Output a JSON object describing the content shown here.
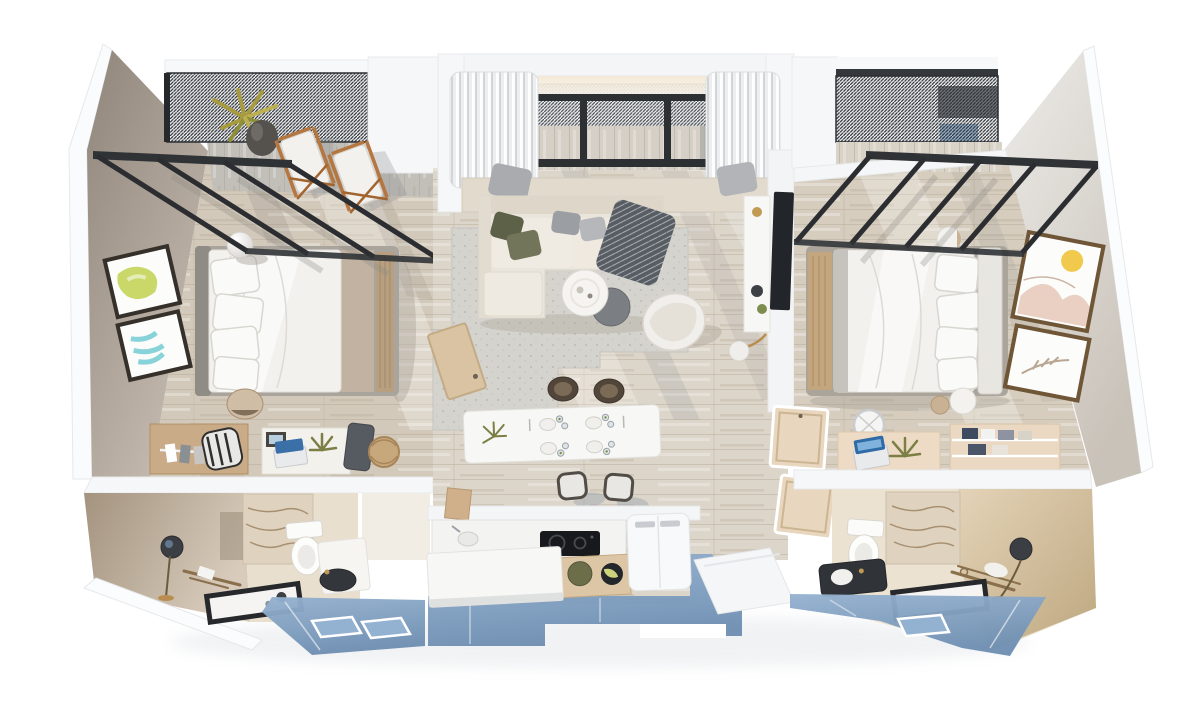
{
  "scene": {
    "title": "3D cutaway floor plan render of a two-bedroom apartment, top-down axonometric view",
    "view": "top-down 3d cutaway",
    "background": "#ffffff"
  },
  "palette": {
    "wall_white": "#f5f6f7",
    "wall_taupe": "#9d9187",
    "wall_light_gray": "#dcd8d2",
    "wood_floor": "#d6cdbf",
    "deck_gray": "#c2bfb9",
    "rug_gray": "#d5d3ce",
    "sofa_beige": "#eae5dc",
    "pillow_olive": "#6e7253",
    "throw_charcoal": "#585d64",
    "glass_blue": "#82a0c0",
    "pergola_black": "#2c2f33",
    "travertine": "#dfd3bf",
    "cabinet_tan": "#dcc6a5",
    "accent_gold": "#c09a55",
    "art_lime": "#c9d869",
    "art_cyan": "#74ccd4",
    "art_yellow": "#f1ca4d",
    "laptop_blue": "#2f6ba6"
  },
  "rooms": {
    "terrace": {
      "label": "Roof terrace with louvered pergola canopies",
      "items": [
        "louvered mesh canopy",
        "black steel glass-canopy frames",
        "two wooden deck chairs with white canvas",
        "potted agave plant",
        "timber deck"
      ]
    },
    "left_bedroom": {
      "label": "Left bedroom",
      "items": [
        "double bed with white duvet and four pillows",
        "gray upholstered headboard",
        "two framed artworks (lime and teal)",
        "white sphere lamp",
        "round side stool",
        "wardrobe with clothes rail",
        "striped desk chair",
        "desk with photo frame and blue laptop",
        "potted plant",
        "dark travel bag",
        "woven basket"
      ]
    },
    "left_bathroom": {
      "label": "Left en-suite bathroom",
      "items": [
        "travertine feature wall",
        "toilet",
        "vanity with dark round basin",
        "sphere floor lamp",
        "brass towel rail",
        "black-framed display tray"
      ]
    },
    "living_room": {
      "label": "Living room",
      "items": [
        "L-shaped beige sectional sofa",
        "olive and gray cushions",
        "charcoal patterned throw",
        "white round coffee table",
        "gray round coffee table",
        "white swivel lounge chair",
        "speckled gray area rug",
        "window bench with curtains",
        "TV on white media wall",
        "arc floor lamp",
        "open timber door"
      ]
    },
    "dining_area": {
      "label": "Dining area",
      "items": [
        "white rectangular dining table",
        "four place settings with glassware",
        "small centerpiece plant",
        "four dark timber chairs"
      ]
    },
    "kitchen": {
      "label": "Kitchen",
      "items": [
        "white counter with induction cooktop",
        "sink",
        "tan cabinet with decorative bowls",
        "white island bench",
        "white refrigerator",
        "white entry step platform"
      ]
    },
    "hallway": {
      "label": "Hallway",
      "items": [
        "two tan wardrobe doors",
        "timber plank flooring"
      ]
    },
    "right_bedroom": {
      "label": "Right bedroom",
      "items": [
        "double bed with white duvet and four pillows",
        "tan timber foot bench",
        "two framed artworks (yellow sun and leaf sketch)",
        "two round poufs",
        "wire desk chair",
        "desk with blue laptop and plant",
        "tan open shelf with towels"
      ]
    },
    "right_bathroom": {
      "label": "Right en-suite bathroom",
      "items": [
        "travertine feature wall",
        "tan stone wall",
        "toilet",
        "dark vanity counter with white basin",
        "brass towel rack with towel",
        "sphere wall lamp",
        "black-framed display tray"
      ]
    },
    "glazing": {
      "label": "Floor-to-ceiling glass walls rendered as blue panels along the south facade"
    }
  }
}
